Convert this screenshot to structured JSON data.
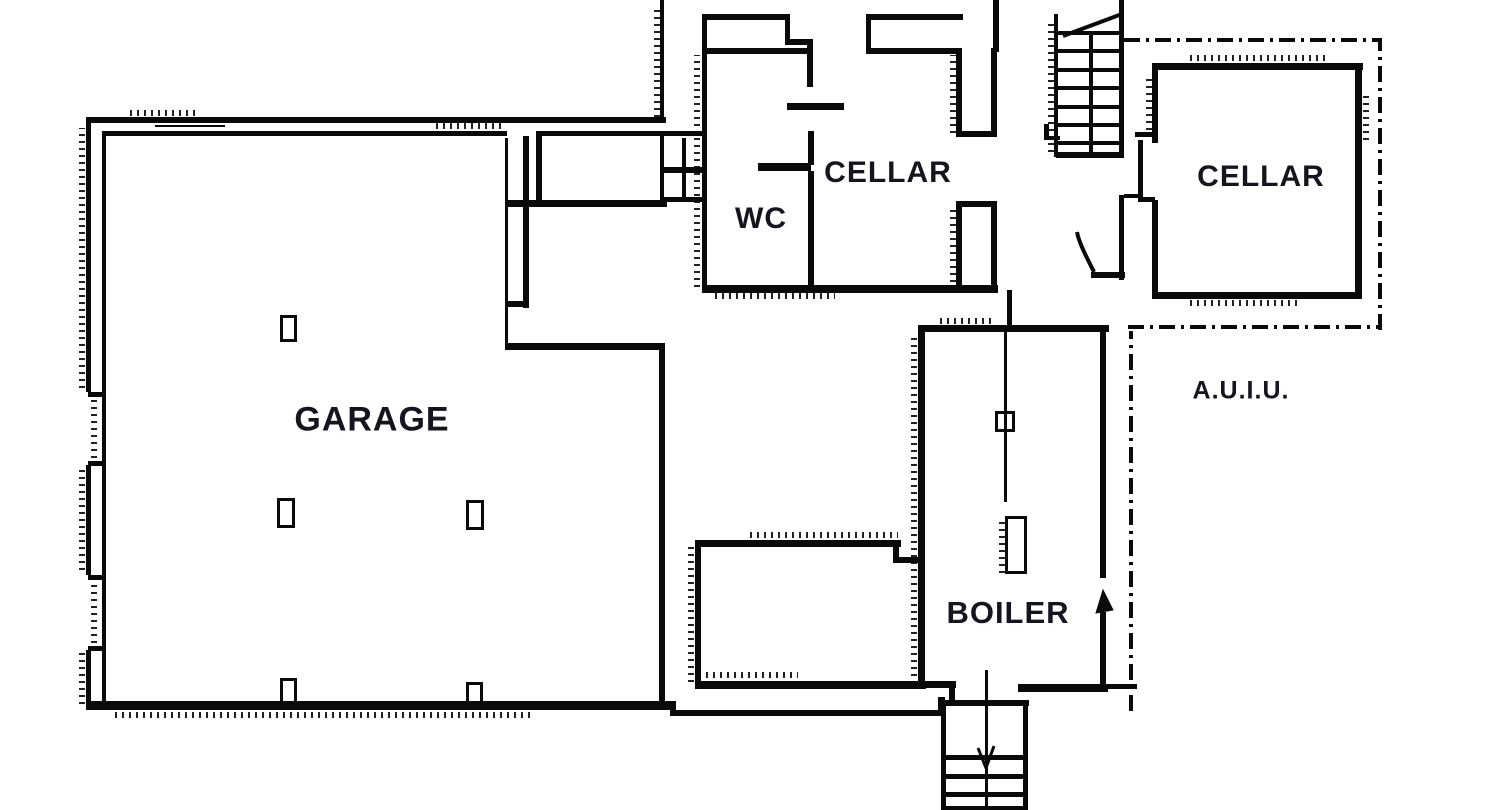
{
  "meta": {
    "width": 1500,
    "height": 810,
    "ink_color": "#0a0a0a",
    "background_color": "#ffffff",
    "label_color": "#15151f"
  },
  "rooms": {
    "garage": {
      "label": "GARAGE",
      "x": 372,
      "y": 420,
      "size": 34
    },
    "wc": {
      "label": "WC",
      "x": 761,
      "y": 219,
      "size": 30
    },
    "cellar_left": {
      "label": "CELLAR",
      "x": 888,
      "y": 173,
      "size": 30
    },
    "cellar_right": {
      "label": "CELLAR",
      "x": 1261,
      "y": 177,
      "size": 30
    },
    "boiler": {
      "label": "BOILER",
      "x": 1008,
      "y": 613,
      "size": 31
    },
    "auiu": {
      "label": "A.U.I.U.",
      "x": 1241,
      "y": 391,
      "size": 25
    }
  },
  "geometry": {
    "walls": [
      [
        86,
        117,
        580,
        6
      ],
      [
        102,
        131,
        405,
        5
      ],
      [
        536,
        131,
        171,
        5
      ],
      [
        86,
        117,
        5,
        275
      ],
      [
        86,
        465,
        5,
        110
      ],
      [
        86,
        650,
        5,
        58
      ],
      [
        102,
        131,
        4,
        574
      ],
      [
        88,
        392,
        14,
        5
      ],
      [
        88,
        461,
        14,
        5
      ],
      [
        88,
        575,
        14,
        5
      ],
      [
        88,
        646,
        14,
        5
      ],
      [
        155,
        125,
        70,
        2
      ],
      [
        86,
        701,
        590,
        9
      ],
      [
        670,
        710,
        275,
        6
      ],
      [
        938,
        697,
        7,
        19
      ],
      [
        943,
        700,
        86,
        6
      ],
      [
        659,
        347,
        6,
        356
      ],
      [
        505,
        343,
        160,
        7
      ],
      [
        523,
        136,
        6,
        172
      ],
      [
        505,
        138,
        3,
        207
      ],
      [
        505,
        301,
        24,
        6
      ],
      [
        536,
        136,
        6,
        67
      ],
      [
        505,
        200,
        162,
        7
      ],
      [
        660,
        136,
        4,
        66
      ],
      [
        682,
        138,
        4,
        62
      ],
      [
        660,
        167,
        46,
        6
      ],
      [
        660,
        197,
        46,
        5
      ],
      [
        660,
        0,
        4,
        122
      ],
      [
        702,
        14,
        5,
        278
      ],
      [
        702,
        14,
        88,
        6
      ],
      [
        785,
        14,
        5,
        30
      ],
      [
        785,
        39,
        28,
        6
      ],
      [
        807,
        39,
        6,
        48
      ],
      [
        702,
        48,
        108,
        6
      ],
      [
        787,
        103,
        57,
        7
      ],
      [
        808,
        131,
        6,
        34
      ],
      [
        758,
        163,
        53,
        8
      ],
      [
        808,
        171,
        6,
        121
      ],
      [
        702,
        285,
        296,
        8
      ],
      [
        866,
        14,
        97,
        6
      ],
      [
        866,
        14,
        5,
        40
      ],
      [
        866,
        48,
        94,
        6
      ],
      [
        993,
        0,
        6,
        52
      ],
      [
        956,
        48,
        6,
        89
      ],
      [
        991,
        48,
        6,
        89
      ],
      [
        956,
        131,
        41,
        6
      ],
      [
        956,
        201,
        41,
        6
      ],
      [
        956,
        201,
        6,
        91
      ],
      [
        991,
        201,
        6,
        91
      ],
      [
        1007,
        290,
        5,
        42
      ],
      [
        1054,
        14,
        4,
        143
      ],
      [
        1058,
        31,
        64,
        4
      ],
      [
        1058,
        49,
        64,
        4
      ],
      [
        1058,
        68,
        64,
        4
      ],
      [
        1058,
        86,
        64,
        4
      ],
      [
        1058,
        105,
        64,
        4
      ],
      [
        1058,
        123,
        64,
        4
      ],
      [
        1058,
        141,
        64,
        4
      ],
      [
        1089,
        31,
        4,
        126
      ],
      [
        1119,
        0,
        5,
        158
      ],
      [
        1056,
        152,
        68,
        6
      ],
      [
        1044,
        124,
        5,
        16
      ],
      [
        1044,
        136,
        16,
        4
      ],
      [
        1135,
        132,
        20,
        5
      ],
      [
        1119,
        195,
        5,
        85
      ],
      [
        1091,
        272,
        34,
        6
      ],
      [
        1124,
        194,
        18,
        4
      ],
      [
        1152,
        63,
        211,
        7
      ],
      [
        1152,
        63,
        6,
        80
      ],
      [
        1138,
        140,
        5,
        62
      ],
      [
        1138,
        197,
        17,
        5
      ],
      [
        1152,
        200,
        6,
        99
      ],
      [
        1355,
        63,
        7,
        236
      ],
      [
        1152,
        292,
        210,
        7
      ],
      [
        918,
        325,
        191,
        7
      ],
      [
        918,
        325,
        7,
        363
      ],
      [
        1100,
        332,
        6,
        246
      ],
      [
        1100,
        612,
        6,
        76
      ],
      [
        918,
        681,
        38,
        7
      ],
      [
        949,
        685,
        6,
        17
      ],
      [
        1018,
        684,
        90,
        8
      ],
      [
        1103,
        684,
        34,
        5
      ],
      [
        1004,
        332,
        3,
        170
      ],
      [
        695,
        540,
        206,
        7
      ],
      [
        695,
        540,
        6,
        148
      ],
      [
        893,
        545,
        6,
        18
      ],
      [
        896,
        557,
        26,
        6
      ],
      [
        695,
        681,
        231,
        8
      ],
      [
        941,
        700,
        5,
        110
      ],
      [
        1023,
        700,
        5,
        110
      ],
      [
        943,
        755,
        82,
        5
      ],
      [
        943,
        774,
        82,
        5
      ],
      [
        943,
        792,
        82,
        5
      ],
      [
        943,
        806,
        82,
        4
      ],
      [
        985,
        670,
        3,
        140
      ]
    ],
    "boxes": [
      [
        280,
        315,
        17,
        27
      ],
      [
        277,
        498,
        18,
        30
      ],
      [
        466,
        500,
        18,
        30
      ],
      [
        280,
        678,
        17,
        27
      ],
      [
        466,
        682,
        17,
        24
      ],
      [
        995,
        411,
        20,
        21
      ],
      [
        1005,
        516,
        22,
        58
      ]
    ],
    "dashdot": [
      {
        "o": "h",
        "x": 1124,
        "y": 38,
        "len": 258
      },
      {
        "o": "v",
        "x": 1378,
        "y": 40,
        "len": 290
      },
      {
        "o": "h",
        "x": 1128,
        "y": 325,
        "len": 253
      },
      {
        "o": "v",
        "x": 1129,
        "y": 331,
        "len": 380
      }
    ],
    "hatches": [
      {
        "o": "v",
        "x": 79,
        "y": 128,
        "len": 260
      },
      {
        "o": "v",
        "x": 79,
        "y": 470,
        "len": 100
      },
      {
        "o": "v",
        "x": 79,
        "y": 652,
        "len": 52
      },
      {
        "o": "v",
        "x": 91,
        "y": 394,
        "len": 64
      },
      {
        "o": "v",
        "x": 91,
        "y": 577,
        "len": 66
      },
      {
        "o": "h",
        "x": 130,
        "y": 110,
        "len": 70
      },
      {
        "o": "h",
        "x": 436,
        "y": 123,
        "len": 66
      },
      {
        "o": "h",
        "x": 115,
        "y": 712,
        "len": 420
      },
      {
        "o": "v",
        "x": 694,
        "y": 55,
        "len": 232
      },
      {
        "o": "v",
        "x": 654,
        "y": 5,
        "len": 112
      },
      {
        "o": "v",
        "x": 911,
        "y": 335,
        "len": 348
      },
      {
        "o": "h",
        "x": 750,
        "y": 532,
        "len": 148
      },
      {
        "o": "v",
        "x": 688,
        "y": 546,
        "len": 136
      },
      {
        "o": "h",
        "x": 706,
        "y": 672,
        "len": 92
      },
      {
        "o": "v",
        "x": 1146,
        "y": 75,
        "len": 62
      },
      {
        "o": "h",
        "x": 1190,
        "y": 55,
        "len": 140
      },
      {
        "o": "v",
        "x": 1363,
        "y": 92,
        "len": 48
      },
      {
        "o": "v",
        "x": 1048,
        "y": 22,
        "len": 130
      },
      {
        "o": "v",
        "x": 950,
        "y": 55,
        "len": 78
      },
      {
        "o": "v",
        "x": 950,
        "y": 205,
        "len": 84
      },
      {
        "o": "v",
        "x": 999,
        "y": 518,
        "len": 55
      },
      {
        "o": "h",
        "x": 940,
        "y": 318,
        "len": 56
      },
      {
        "o": "h",
        "x": 715,
        "y": 293,
        "len": 120
      },
      {
        "o": "h",
        "x": 1190,
        "y": 300,
        "len": 110
      }
    ],
    "paths": [
      {
        "name": "stair-cut-line",
        "d": "M1063,36 L1122,14",
        "w": 4,
        "fill": "none"
      },
      {
        "name": "door-swing",
        "d": "M1094,272 C1087,258 1079,243 1077,232",
        "w": 4,
        "fill": "none"
      },
      {
        "name": "stair-arrow-head",
        "d": "M978,748 L986,768 L994,746",
        "w": 3,
        "fill": "none"
      },
      {
        "name": "boiler-door-arrow",
        "d": "M1096,613 L1103,590 L1113,610 Z",
        "w": 1,
        "fill": "ink"
      }
    ]
  }
}
